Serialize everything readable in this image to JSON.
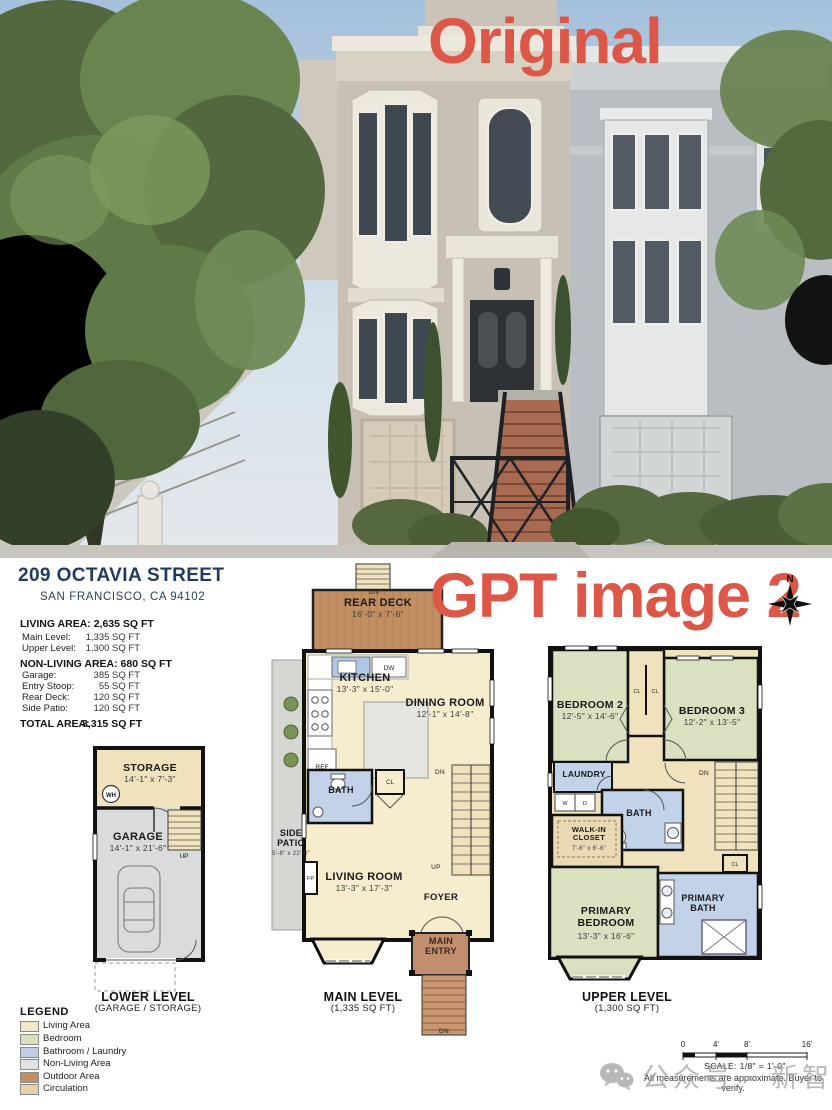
{
  "overlay": {
    "original": "Original",
    "gpt": "GPT image 2"
  },
  "compass": {
    "n": "N"
  },
  "photo": {
    "house_number": "709"
  },
  "header": {
    "title": "209 OCTAVIA STREET",
    "subtitle": "SAN FRANCISCO, CA 94102"
  },
  "summary": {
    "living_label": "LIVING AREA: 2,635 SQ FT",
    "living_rows": [
      {
        "name": "Main Level:",
        "value": "1,335 SQ FT"
      },
      {
        "name": "Upper Level:",
        "value": "1,300 SQ FT"
      }
    ],
    "nonliving_label": "NON-LIVING AREA: 680 SQ FT",
    "nonliving_rows": [
      {
        "name": "Garage:",
        "value": "385 SQ FT"
      },
      {
        "name": "Entry Stoop:",
        "value": "55 SQ FT"
      },
      {
        "name": "Rear Deck:",
        "value": "120 SQ FT"
      },
      {
        "name": "Side Patio:",
        "value": "120 SQ FT"
      }
    ],
    "total_label": "TOTAL AREA:",
    "total_value": "3,315 SQ FT"
  },
  "plans": {
    "lower": {
      "storage_name": "STORAGE",
      "storage_dims": "14'-1\" x 7'-3\"",
      "wh": "WH",
      "garage_name": "GARAGE",
      "garage_dims": "14'-1\" x 21'-6\"",
      "up": "UP",
      "caption": "LOWER LEVEL",
      "subcaption": "(GARAGE / STORAGE)"
    },
    "main": {
      "deck_dn": "DN",
      "rear_deck_name": "REAR DECK",
      "rear_deck_dims": "16'-0\" x 7'-6\"",
      "kitchen_name": "KITCHEN",
      "kitchen_dims": "13'-3\" x 15'-0\"",
      "dw": "DW",
      "ref": "REF",
      "dining_name": "DINING ROOM",
      "dining_dims": "12'-1\" x 14'-8\"",
      "bath": "BATH",
      "cl": "CL",
      "side_patio_name": "SIDE PATIO",
      "side_patio_dims": "5'-6\" x 22'-0\"",
      "living_name": "LIVING ROOM",
      "living_dims": "13'-3\" x 17'-3\"",
      "fp": "FP",
      "dn": "DN",
      "up": "UP",
      "foyer": "FOYER",
      "entry": "MAIN ENTRY",
      "entry_dn": "DN",
      "caption": "MAIN LEVEL",
      "subcaption": "(1,335 SQ FT)"
    },
    "upper": {
      "bedroom2_name": "BEDROOM 2",
      "bedroom2_dims": "12'-5\" x 14'-6\"",
      "cl1": "CL",
      "cl2": "CL",
      "cl3": "CL",
      "bedroom3_name": "BEDROOM 3",
      "bedroom3_dims": "12'-2\" x 13'-5\"",
      "laundry": "LAUNDRY",
      "w": "W",
      "d": "D",
      "bath": "BATH",
      "wic_name": "WALK-IN CLOSET",
      "wic_dims": "7'-6\" x 6'-6\"",
      "dn": "DN",
      "primary_bedroom_name": "PRIMARY BEDROOM",
      "primary_bedroom_dims": "13'-3\" x 16'-6\"",
      "primary_bath": "PRIMARY BATH",
      "caption": "UPPER LEVEL",
      "subcaption": "(1,300 SQ FT)"
    }
  },
  "legend": {
    "title": "LEGEND",
    "items": [
      {
        "label": "Living Area",
        "color": "#F2E8C6"
      },
      {
        "label": "Bedroom",
        "color": "#D8E0BF"
      },
      {
        "label": "Bathroom / Laundry",
        "color": "#BDCFE7"
      },
      {
        "label": "Non-Living Area",
        "color": "#DFE1E2"
      },
      {
        "label": "Outdoor Area",
        "color": "#C18E66"
      },
      {
        "label": "Circulation",
        "color": "#E7D3A9"
      }
    ]
  },
  "scalebar": {
    "ticks": [
      "0",
      "4'",
      "8'",
      "16'"
    ],
    "text": "SCALE: 1/8\" = 1'-0\"",
    "disclaimer": "All measurements are approximate. Buyer to verify."
  },
  "watermark": {
    "text": "公众号 · 新智元"
  },
  "colors": {
    "accent_red": "#DC5748",
    "header_navy": "#1F3B5E",
    "wall": "#111111",
    "living": "#F6EDCF",
    "bedroom": "#D9E1C1",
    "bath": "#C2D2E8",
    "nonliving": "#D9DBDC",
    "outdoor": "#C28F63",
    "circulation": "#EFE2BC",
    "patio": "#D6D7D3"
  }
}
